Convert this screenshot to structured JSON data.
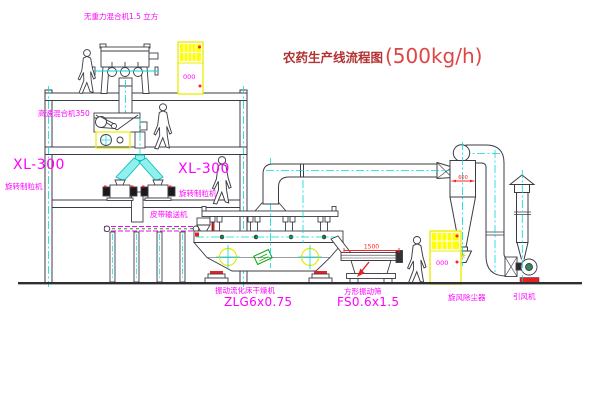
{
  "title": {
    "text": "农药生产线流程图",
    "capacity": "(500kg/h)"
  },
  "labels": {
    "gravity_mixer": "无重力混合机1.5 立方",
    "high_speed_mixer": "高速混合机350",
    "granulator_left_model": "XL-300",
    "granulator_left_name": "旋转制粒机",
    "granulator_right_model": "XL-300",
    "granulator_right_name": "旋转制粒机",
    "belt_conveyor": "皮带输送机",
    "dryer_name": "振动流化床干燥机",
    "dryer_model": "ZLG6x0.75",
    "screen_name": "方形振动筛",
    "screen_model": "FS0.6x1.5",
    "cyclone": "旋风除尘器",
    "induced_draft_fan": "引风机"
  },
  "dimensions": {
    "screen_length": "1500",
    "cyclone_diameter": "600"
  },
  "cabinets": {
    "panel_text": "000"
  },
  "colors": {
    "label_magenta": "#ff00ff",
    "title_dark_red": "#b23333",
    "title_red": "#e04444",
    "centerline_cyan": "#00d9d9",
    "cabinet_yellow": "#ecec00",
    "dimension_red": "#ff2222",
    "line_dark": "#3c3c46"
  }
}
